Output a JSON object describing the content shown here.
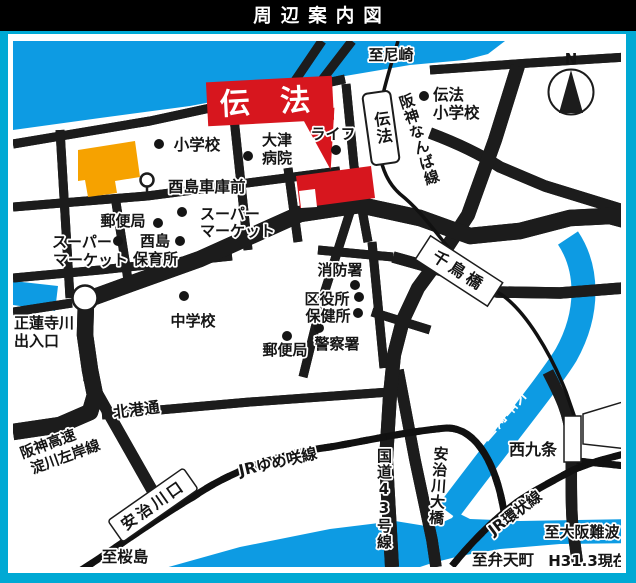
{
  "title": "周辺案内図",
  "colors": {
    "frame_cyan": "#00a9d4",
    "water_blue": "#0d9be3",
    "highway_tan": "#cbc096",
    "accent_red": "#d7161e",
    "building_orange": "#f6a200",
    "title_bar_black": "#000000"
  },
  "labels": {
    "to_amagasaki": "至尼崎",
    "denpo_callout": "伝 法",
    "denpo_station": "伝法",
    "hanshin_namba_line": "阪神なんば線",
    "denpo_elem_l1": "伝法",
    "denpo_elem_l2": "小学校",
    "life": "ライフ",
    "elementary_school": "小学校",
    "otsu_hospital_l1": "大津",
    "otsu_hospital_l2": "病院",
    "torishima_depot": "酉島車庫前",
    "post_office_1": "郵便局",
    "supermarket1_l1": "スーパー",
    "supermarket1_l2": "マーケット",
    "supermarket2_l1": "スーパー",
    "supermarket2_l2": "マーケット",
    "torishima": "酉島",
    "nursery": "保育所",
    "shorenji_l1": "正蓮寺川",
    "shorenji_l2": "出入口",
    "junior_high": "中学校",
    "fire_station": "消防署",
    "ward_office": "区役所",
    "health_center": "保健所",
    "police_station": "警察署",
    "post_office_2": "郵便局",
    "chidoribashi": "千鳥橋",
    "rokkenyagawa": "六軒家川",
    "hokko_dori": "北港通",
    "hanshin_exp_l1": "阪神高速",
    "hanshin_exp_l2": "淀川左岸線",
    "jr_yumesaki": "JRゆめ咲線",
    "ajikawaguchi": "安治川口",
    "to_sakurajima": "至桜島",
    "route43": "国道43号線",
    "ajikawa_bridge": "安治川大橋",
    "nishikujo": "西九条",
    "jr_loop": "JR環状線",
    "to_osaka_namba": "至大阪難波",
    "to_bentencho": "至弁天町",
    "as_of": "H31.3現在",
    "compass_n": "N"
  }
}
